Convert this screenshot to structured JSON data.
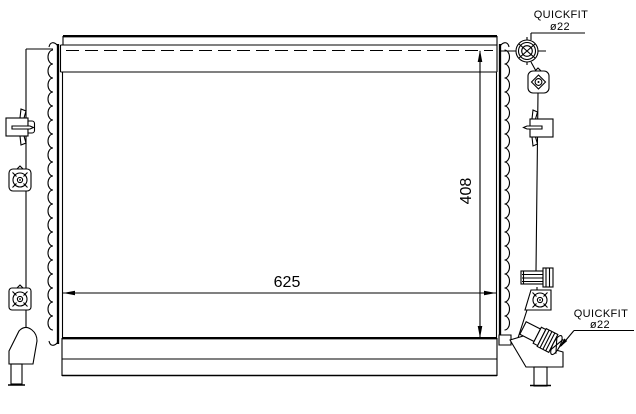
{
  "drawing": {
    "background": "#ffffff",
    "line_color": "#000000",
    "dimensions": {
      "width_label": "625",
      "height_label": "408"
    },
    "fittings": {
      "top": {
        "name": "QUICKFIT",
        "diameter": "ø22"
      },
      "bottom": {
        "name": "QUICKFIT",
        "diameter": "ø22"
      }
    }
  }
}
